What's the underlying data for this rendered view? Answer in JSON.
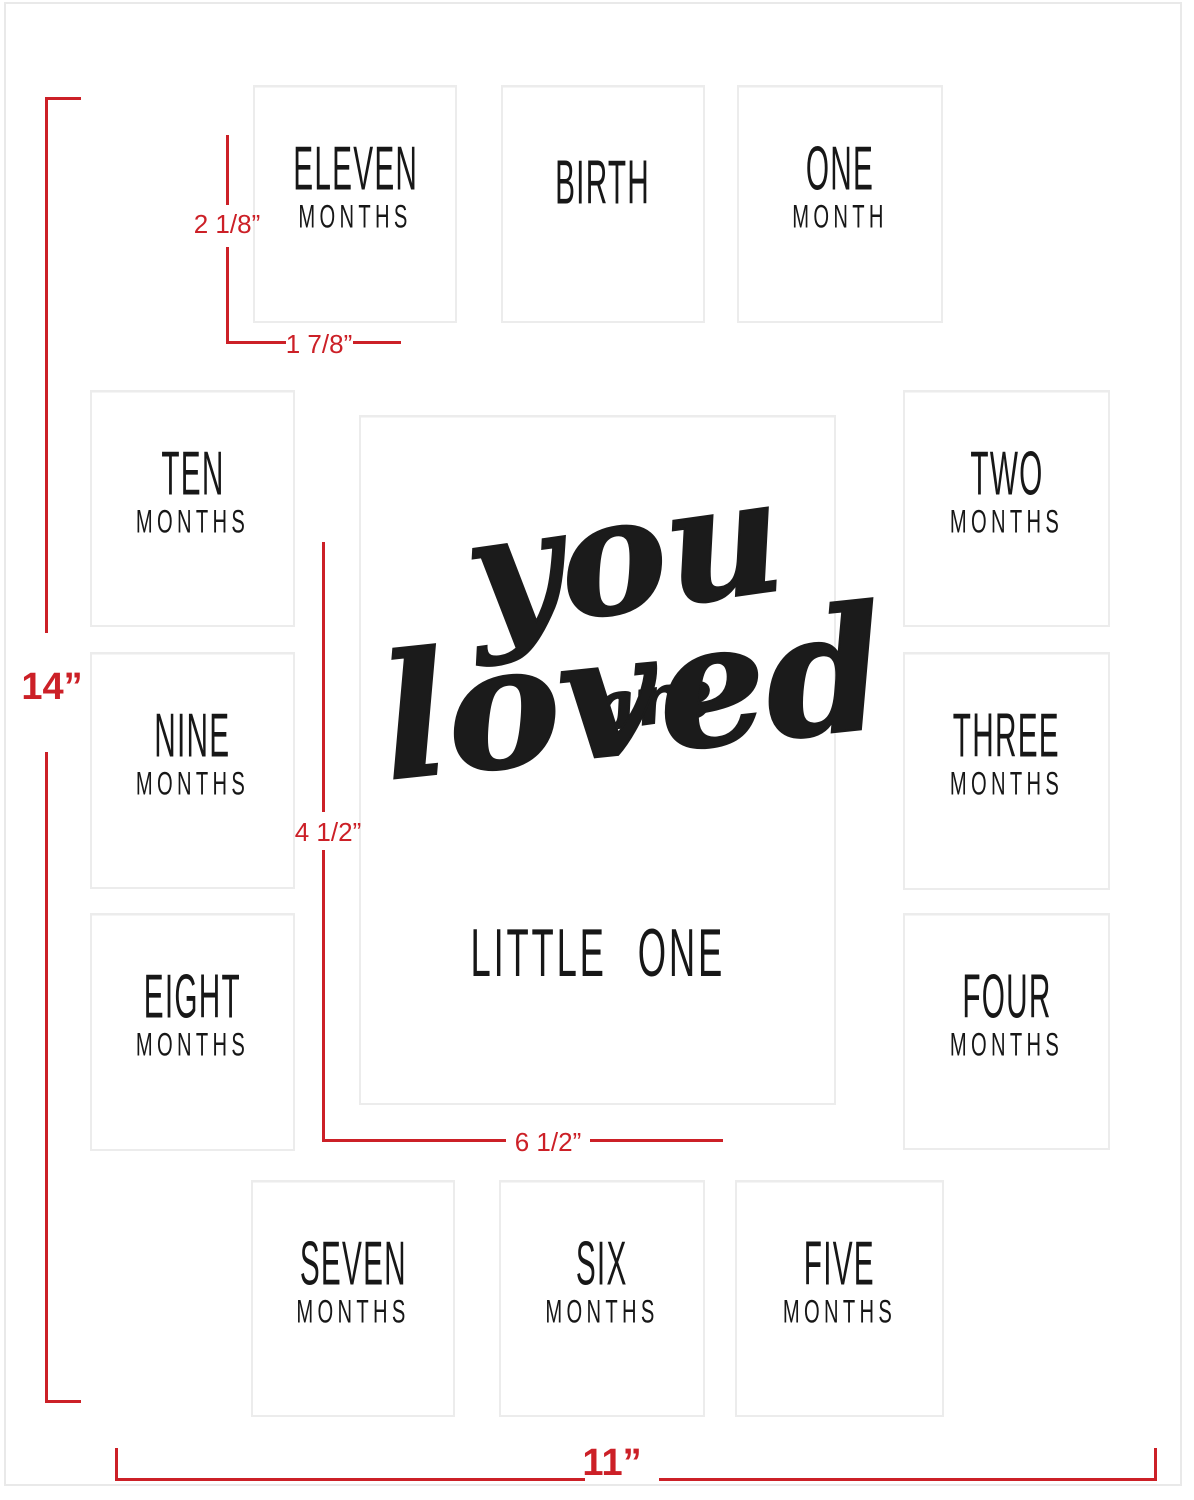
{
  "center": {
    "script_line1": "you",
    "script_line2": "are",
    "script_line3": "loved",
    "subtitle": "LITTLE ONE"
  },
  "openings": [
    {
      "title": "ELEVEN",
      "subtitle": "MONTHS"
    },
    {
      "title": "BIRTH",
      "subtitle": ""
    },
    {
      "title": "ONE",
      "subtitle": "MONTH"
    },
    {
      "title": "TEN",
      "subtitle": "MONTHS"
    },
    {
      "title": "TWO",
      "subtitle": "MONTHS"
    },
    {
      "title": "NINE",
      "subtitle": "MONTHS"
    },
    {
      "title": "THREE",
      "subtitle": "MONTHS"
    },
    {
      "title": "EIGHT",
      "subtitle": "MONTHS"
    },
    {
      "title": "FOUR",
      "subtitle": "MONTHS"
    },
    {
      "title": "SEVEN",
      "subtitle": "MONTHS"
    },
    {
      "title": "SIX",
      "subtitle": "MONTHS"
    },
    {
      "title": "FIVE",
      "subtitle": "MONTHS"
    }
  ],
  "dimensions": {
    "mat_height": "14”",
    "mat_width": "11”",
    "small_opening_height": "2 1/8”",
    "small_opening_width": "1 7/8”",
    "center_opening_height": "4 1/2”",
    "center_opening_width": "6 1/2”"
  },
  "colors": {
    "dimension_red": "#cc2027",
    "ink_black": "#1b1b1b",
    "opening_border_gray": "#ececec"
  }
}
